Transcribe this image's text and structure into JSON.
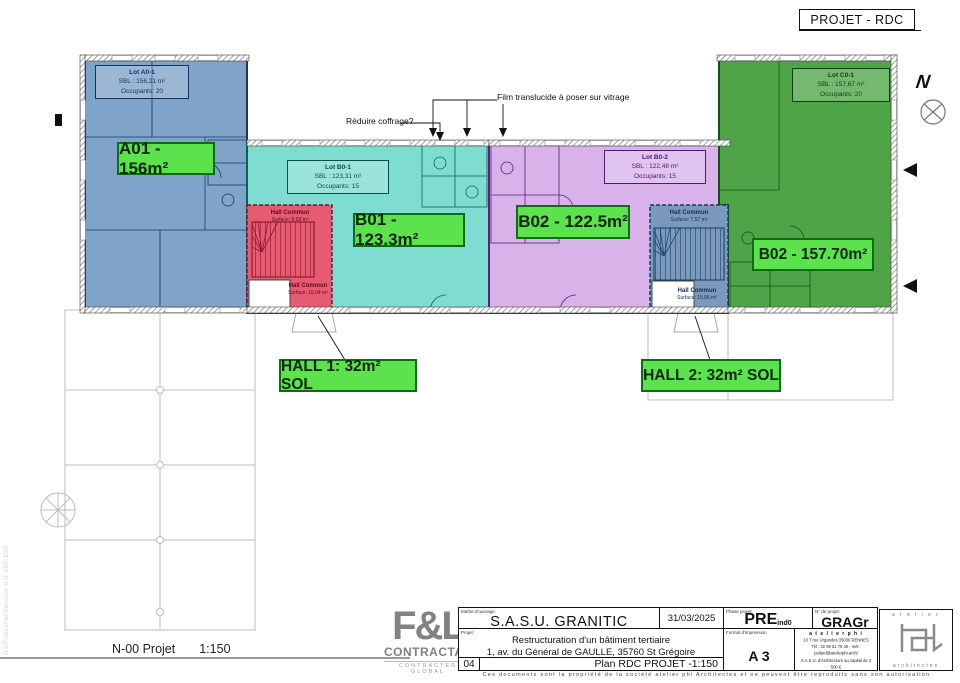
{
  "title": "PROJET - RDC",
  "watermark": "GSPublisherVersion 0.0.100.100",
  "plan": {
    "north_label": "N",
    "lots": [
      {
        "name": "Lot A0-1",
        "sbl": "SBL : 156,21 m²",
        "occ": "Occupants: 20"
      },
      {
        "name": "Lot B0-1",
        "sbl": "SBL : 123,31 m²",
        "occ": "Occupants: 15"
      },
      {
        "name": "Lot B0-2",
        "sbl": "SBL : 122,48 m²",
        "occ": "Occupants: 15"
      },
      {
        "name": "Lot C0-1",
        "sbl": "SBL : 157,67 m²",
        "occ": "Occupants: 20"
      }
    ],
    "area_labels": [
      {
        "text": "A01 - 156m²"
      },
      {
        "text": "B01 - 123.3m²"
      },
      {
        "text": "B02 - 122.5m²"
      },
      {
        "text": "B02 - 157.70m²"
      },
      {
        "text": "HALL 1: 32m² SOL"
      },
      {
        "text": "HALL 2: 32m² SOL"
      }
    ],
    "hall_labels": [
      {
        "name": "Hall Commun",
        "surface": "Surface: 8,03 m²"
      },
      {
        "name": "Hall Commun",
        "surface": "Surface: 16,04 m²"
      },
      {
        "name": "Hall Commun",
        "surface": "Surface: 7,57 m²"
      },
      {
        "name": "Hall Commun",
        "surface": "Surface: 15,06 m²"
      }
    ],
    "annotations": {
      "reduce_formwork": "Réduire coffrage?",
      "translucent_film": "Film translucide à poser sur vitrage"
    }
  },
  "footer": {
    "drawing_name": "N-00 Projet",
    "drawing_scale": "1:150",
    "contractor_logo": {
      "brand": "F&L",
      "name": "CONTRACTANT",
      "tagline": "CONTRACTER GLOBAL"
    },
    "titleblock": {
      "client_label": "Maître d'ouvrage:",
      "client": "S.A.S.U. GRANITIC",
      "date": "31/03/2025",
      "phase_label": "Phase projet:",
      "phase": "PRE",
      "phase_index": "ind0",
      "project_no_label": "N° de projet:",
      "project_no": "GRAGr",
      "project_label": "Projet :",
      "project_line1": "Restructuration d'un bâtiment tertiaire",
      "project_line2": "1, av. du Général de GAULLE, 35760 St Grégoire",
      "format_label": "Format d'impression",
      "format": "A 3",
      "sheet_no": "04",
      "sheet_title": "Plan RDC PROJET  -1:150",
      "architect_name": "a t e l i e r   p h i",
      "architect_lines": [
        "10 T rue Urgandes 35000 RENNES",
        "Tél : 02 99 51 79 40 - mél : poliard@atelierphi.archi",
        "S.A.S.U. d'Architecture au capital de 2 500 €",
        "827 735 655 R.C.S. Rennes",
        "Inscription au Tableau de l'Ordre des Architectes sous le N°S10625"
      ],
      "architect_logo_top": "a t e l i e r",
      "architect_logo_bottom": "architectes",
      "copyright": "Ces documents sont la propriété de la société atelier phi Architectes et ne peuvent être reproduits sans son autorisation"
    }
  },
  "colors": {
    "lot_a_fill": "#7fa3c9",
    "lot_b1_fill": "#7eddd0",
    "lot_b2_fill": "#d8b2e9",
    "lot_c_fill": "#4fa447",
    "hall1_fill": "#e65a72",
    "hall2_fill": "#7b98bd",
    "label_green": "#5be24d"
  }
}
